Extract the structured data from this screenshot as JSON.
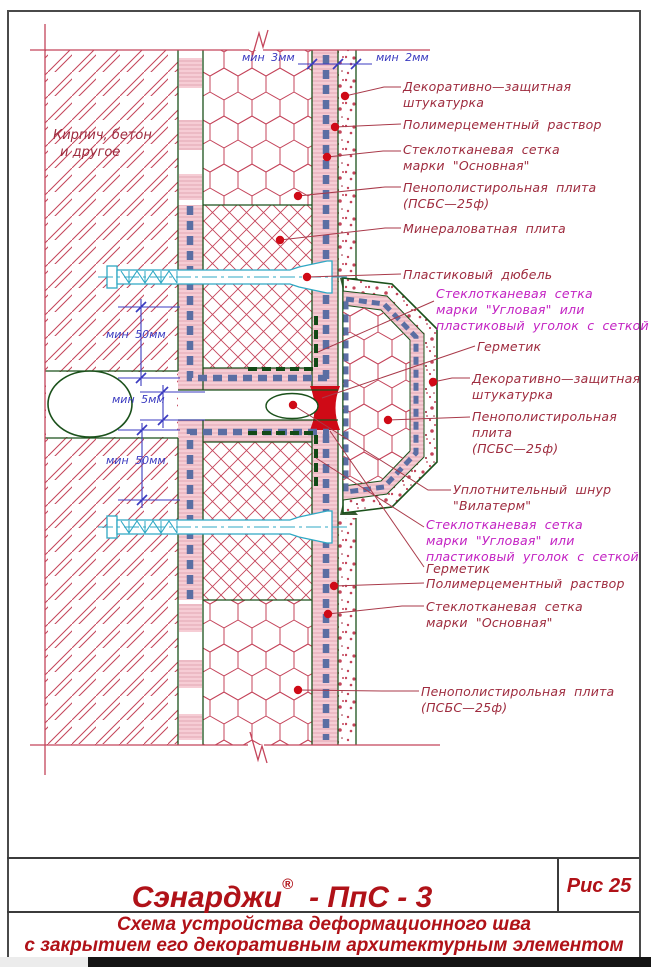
{
  "page": {
    "figure_number": "Рис 25",
    "title": {
      "brand": "Сэнарджи",
      "registered_mark": "®",
      "code": "- ПпС - 3"
    },
    "subtitle": [
      "Схема устройства деформационного шва",
      "с закрытием его декоративным архитектурным элементом"
    ]
  },
  "drawing": {
    "wall_note": [
      "Кирпич, бетон",
      "и другое"
    ],
    "dimensions": {
      "top_inner": "мин 3мм",
      "top_outer": "мин 2мм",
      "upper_offset": "мин 50мм",
      "joint_gap": "мин 5мм",
      "lower_offset": "мин 50мм"
    },
    "callouts": [
      {
        "color": "red",
        "lines": [
          "Декоративно—защитная",
          "штукатурка"
        ]
      },
      {
        "color": "red",
        "lines": [
          "Полимерцементный раствор"
        ]
      },
      {
        "color": "red",
        "lines": [
          "Стеклотканевая сетка",
          "марки \"Основная\""
        ]
      },
      {
        "color": "red",
        "lines": [
          "Пенополистирольная плита",
          "(ПСБС—25ф)"
        ]
      },
      {
        "color": "red",
        "lines": [
          "Минераловатная плита"
        ]
      },
      {
        "color": "red",
        "lines": [
          "Пластиковый дюбель"
        ]
      },
      {
        "color": "magenta",
        "lines": [
          "Стеклотканевая сетка",
          "марки \"Угловая\" или",
          "пластиковый уголок с сеткой"
        ]
      },
      {
        "color": "red",
        "lines": [
          "Герметик"
        ]
      },
      {
        "color": "red",
        "lines": [
          "Декоративно—защитная",
          "штукатурка"
        ]
      },
      {
        "color": "red",
        "lines": [
          "Пенополистирольная",
          "плита",
          "(ПСБС—25ф)"
        ]
      },
      {
        "color": "red",
        "lines": [
          "Уплотнительный шнур",
          "\"Вилатерм\""
        ]
      },
      {
        "color": "magenta",
        "lines": [
          "Стеклотканевая сетка",
          "марки \"Угловая\" или",
          "пластиковый уголок с сеткой"
        ]
      },
      {
        "color": "red",
        "lines": [
          "Герметик"
        ]
      },
      {
        "color": "red",
        "lines": [
          "Полимерцементный раствор"
        ]
      },
      {
        "color": "red",
        "lines": [
          "Стеклотканевая сетка",
          "марки \"Основная\""
        ]
      },
      {
        "color": "red",
        "lines": [
          "Пенополистирольная плита",
          "(ПСБС—25ф)"
        ]
      }
    ]
  },
  "colors": {
    "hatch_crimson": "#C4455B",
    "label_red": "#9E2B3E",
    "label_magenta": "#C322C3",
    "dimension_blue": "#3B3BC0",
    "mesh_blue": "#5B6EA3",
    "outline_green": "#1B511B",
    "corner_mesh_green": "#124A16",
    "dowel_cyan": "#2FA8C4",
    "sealant_red": "#CF0A16",
    "plaster_pink": "#F6CDD5",
    "title_red": "#B01218"
  }
}
